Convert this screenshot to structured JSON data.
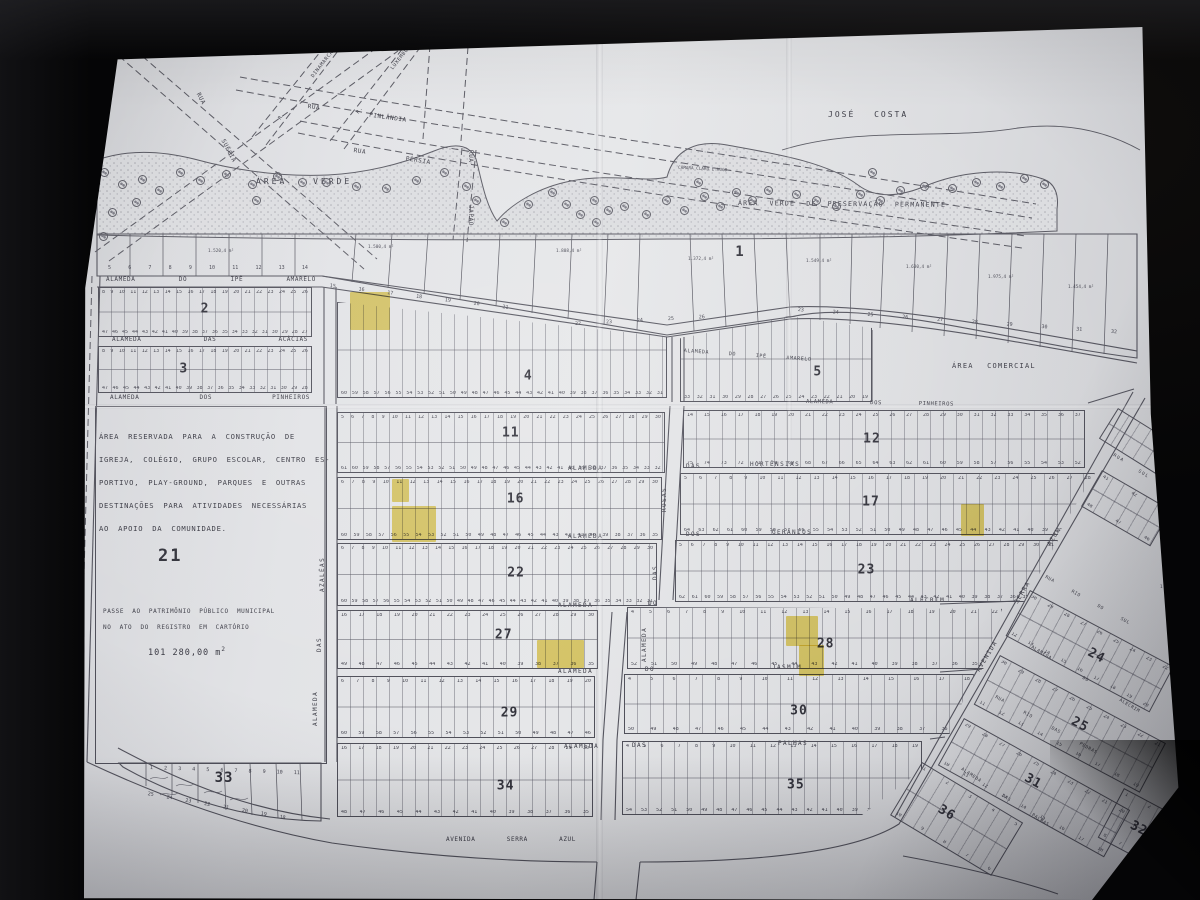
{
  "labels": {
    "owner": "JOSÉ COSTA",
    "area_verde": "ÁREA VERDE",
    "preservacao": "ÁREA VERDE DE PRESERVAÇÃO PERMANENTE",
    "comercial": "ÁREA COMERCIAL",
    "camara": "CÂMARA CLARO E HUGO"
  },
  "reserved": {
    "lines": [
      "ÁREA RESERVADA PARA A CONSTRUÇÃO DE",
      "IGREJA, COLÉGIO, GRUPO ESCOLAR, CENTRO ES-",
      "PORTIVO, PLAY-GROUND, PARQUES E OUTRAS",
      "DESTINAÇÕES PARA ATIVIDADES NECESSÁRIAS",
      "AO APOIO DA COMUNIDADE."
    ],
    "number": "21",
    "passe_lines": [
      "PASSE AO PATRIMÔNIO PÚBLICO MUNICIPAL",
      "NO ATO DO REGISTRO EM CARTÓRIO"
    ],
    "area_value": "101 280,00 m",
    "area_sup": "2"
  },
  "street_labels": [
    {
      "id": "alameda-do-ipe-amarelo-w",
      "t": "ALAMEDA DO IPÊ AMARELO",
      "x": 106,
      "y": 277,
      "r": 0,
      "w": 210
    },
    {
      "id": "alameda-do-ipe-amarelo-e",
      "t": "ALAMEDA DO IPÊ AMARELO",
      "x": 684,
      "y": 349,
      "r": 4,
      "w": 128,
      "fs": 5
    },
    {
      "id": "alameda-das-acacias",
      "t": "ALAMEDA DAS ACÁCIAS",
      "x": 112,
      "y": 337,
      "r": 0,
      "w": 196
    },
    {
      "id": "alameda-dos-pinheiros-w",
      "t": "ALAMEDA DOS PINHEIROS",
      "x": 110,
      "y": 395,
      "r": 0,
      "w": 200
    },
    {
      "id": "alameda-dos-pinheiros-e",
      "t": "ALAMEDA DOS PINHEIROS",
      "x": 806,
      "y": 400,
      "r": 1,
      "w": 148,
      "fs": 5.5
    },
    {
      "id": "alameda-das-hortensias-1",
      "t": "ALAMEDA",
      "x": 568,
      "y": 466,
      "r": 0
    },
    {
      "id": "alameda-das-hortensias-2",
      "t": "DAS",
      "x": 686,
      "y": 464,
      "r": 0
    },
    {
      "id": "alameda-das-hortensias-3",
      "t": "HORTÊNSIAS",
      "x": 750,
      "y": 462,
      "r": 0
    },
    {
      "id": "alameda-dos-geranios-1",
      "t": "ALAMEDA",
      "x": 568,
      "y": 534,
      "r": 0
    },
    {
      "id": "alameda-dos-geranios-2",
      "t": "DOS",
      "x": 686,
      "y": 532,
      "r": 0
    },
    {
      "id": "alameda-dos-geranios-3",
      "t": "GERÂNIOS",
      "x": 772,
      "y": 530,
      "r": 0
    },
    {
      "id": "alameda-do-alecrim-1",
      "t": "ALAMEDA",
      "x": 558,
      "y": 603,
      "r": 0
    },
    {
      "id": "alameda-do-alecrim-2",
      "t": "DO",
      "x": 648,
      "y": 601,
      "r": 0
    },
    {
      "id": "alameda-do-alecrim-3",
      "t": "ALECRIM",
      "x": 910,
      "y": 598,
      "r": 0
    },
    {
      "id": "alameda-do-jasmim-1",
      "t": "ALAMEDA",
      "x": 558,
      "y": 669,
      "r": 0
    },
    {
      "id": "alameda-do-jasmim-2",
      "t": "DO",
      "x": 645,
      "y": 667,
      "r": 0
    },
    {
      "id": "alameda-do-jasmim-3",
      "t": "JASMIM",
      "x": 772,
      "y": 665,
      "r": 0
    },
    {
      "id": "alameda-das-palmas-1",
      "t": "ALAMEDA",
      "x": 564,
      "y": 744,
      "r": 0
    },
    {
      "id": "alameda-das-palmas-2",
      "t": "DAS",
      "x": 632,
      "y": 743,
      "r": 0
    },
    {
      "id": "alameda-das-palmas-3",
      "t": "PALMAS",
      "x": 778,
      "y": 741,
      "r": 0
    },
    {
      "id": "alameda-das-rosas-1",
      "t": "ROSAS",
      "x": 662,
      "y": 512,
      "r": -90
    },
    {
      "id": "alameda-das-rosas-2",
      "t": "DAS",
      "x": 653,
      "y": 580,
      "r": -90
    },
    {
      "id": "alameda-das-rosas-3",
      "t": "ALAMEDA",
      "x": 642,
      "y": 662,
      "r": -90
    },
    {
      "id": "alameda-das-azaleas-1",
      "t": "AZALÉAS",
      "x": 320,
      "y": 592,
      "r": -90
    },
    {
      "id": "alameda-das-azaleas-2",
      "t": "DAS",
      "x": 317,
      "y": 652,
      "r": -90
    },
    {
      "id": "alameda-das-azaleas-3",
      "t": "ALAMEDA",
      "x": 313,
      "y": 726,
      "r": -90
    },
    {
      "id": "avenida-serra-azul",
      "t": "AVENIDA SERRA AZUL",
      "x": 446,
      "y": 837,
      "r": 0,
      "w": 130
    },
    {
      "id": "avenida-serra-azul-d1",
      "t": "AVENIDA",
      "x": 976,
      "y": 670,
      "r": -59
    },
    {
      "id": "avenida-serra-azul-d2",
      "t": "SERRA",
      "x": 1014,
      "y": 602,
      "r": -59
    },
    {
      "id": "avenida-serra-azul-d3",
      "t": "AZUL",
      "x": 1047,
      "y": 544,
      "r": -59
    },
    {
      "id": "rua-finlandia",
      "t": "RUA FINLÂNDIA",
      "x": 308,
      "y": 104,
      "r": 8,
      "w": 100
    },
    {
      "id": "rua-persia",
      "t": "RUA PÉRSIA",
      "x": 354,
      "y": 148,
      "r": 9,
      "w": 78
    },
    {
      "id": "rua-japao",
      "t": "RUA JAPÃO",
      "x": 473,
      "y": 150,
      "r": 90,
      "w": 76
    },
    {
      "id": "rua-suecia",
      "t": "RUA SUÉCIA",
      "x": 200,
      "y": 92,
      "r": 62,
      "w": 78
    },
    {
      "id": "rua-dinamarca",
      "t": "R. DINAMARCA",
      "x": 278,
      "y": 118,
      "r": -52,
      "w": 86,
      "fs": 5
    },
    {
      "id": "rua-luxemburgo",
      "t": "R. LUXEMBURGO",
      "x": 356,
      "y": 112,
      "r": -52,
      "w": 92,
      "fs": 5
    },
    {
      "id": "rua-rio-do-sul",
      "t": "RUA RIO DO SUL",
      "x": 1046,
      "y": 576,
      "r": 29,
      "w": 96,
      "fs": 4.5
    },
    {
      "id": "alameda-do-alecrim-d",
      "t": "ALAMEDA DO ALECRIM",
      "x": 1032,
      "y": 646,
      "r": 31,
      "w": 126,
      "fs": 4.5
    },
    {
      "id": "rua-rio-das-pedras",
      "t": "RUA RIO DAS PEDRAS",
      "x": 996,
      "y": 696,
      "r": 29,
      "w": 116,
      "fs": 4.5
    },
    {
      "id": "alameda-das-palmas-d",
      "t": "ALAMEDA DAS PALMAS",
      "x": 962,
      "y": 768,
      "r": 33,
      "w": 104,
      "fs": 4.5
    },
    {
      "id": "rua-ne",
      "t": "RUA",
      "x": 1114,
      "y": 454,
      "r": 32,
      "fs": 4.5
    },
    {
      "id": "rua-ne-sul",
      "t": "SUL",
      "x": 1139,
      "y": 470,
      "r": 32,
      "fs": 4.5
    }
  ],
  "blocks": [
    {
      "n": "2",
      "x": 98,
      "y": 287,
      "w": 214,
      "h": 50,
      "nx": 50,
      "ny": 44,
      "top": "8 9 10 11 12 13 14 15 16 17 18 19 20 21 22 23 24 25 26",
      "bot": "47 46 45 44 43 42 41 40 39 38 37 36 35 34 33 32 31 30 29 28 27"
    },
    {
      "n": "3",
      "x": 98,
      "y": 346,
      "w": 214,
      "h": 47,
      "nx": 40,
      "ny": 48,
      "top": "8 9 10 11 12 13 14 15 16 17 18 19 20 21 22 23 24 25 26",
      "bot": "47 46 45 44 43 42 41 40 39 38 37 36 35 34 33 32 31 30 29 28"
    },
    {
      "n": "4",
      "x": 337,
      "y": 302,
      "w": 330,
      "h": 96,
      "nx": 58,
      "ny": 78,
      "clip": "polygon(0% 0%,100% 36%,100% 100%,0% 100%)",
      "top": "",
      "bot": "60 59 58 57 56 55 54 53 52 51 50 49 48 47 46 45 44 43 42 41 40 39 38 37 36 35 34 33 32 31"
    },
    {
      "n": "5",
      "x": 680,
      "y": 316,
      "w": 192,
      "h": 86,
      "nx": 72,
      "ny": 66,
      "clip": "polygon(0% 26%,57% 0%,100% 14%,100% 100%,0% 100%)",
      "top": "",
      "bot": "33 32 31 30 29 28 27 26 25 24 23 22 21 20 19"
    },
    {
      "n": "11",
      "x": 337,
      "y": 412,
      "w": 328,
      "h": 61,
      "nx": 53,
      "ny": 34,
      "top": "5 6 7 8 9 10 11 12 13 14 15 16 17 18 19 20 21 22 23 24 25 26 27 28 29 30",
      "bot": "61 60 59 58 57 56 55 54 53 52 51 50 49 48 47 46 45 44 43 42 41 40 39 38 37 36 35 34 33 32"
    },
    {
      "n": "12",
      "x": 683,
      "y": 410,
      "w": 402,
      "h": 58,
      "nx": 47,
      "ny": 50,
      "top": "14 15 16 17 18 19 20 21 22 23 24 25 26 27 28 29 30 31 32 33 34 35 36 37",
      "bot": "75 74 73 72 71 70 69 68 67 66 65 64 63 62 61 60 59 58 57 56 55 54 53 52"
    },
    {
      "n": "16",
      "x": 337,
      "y": 477,
      "w": 325,
      "h": 63,
      "nx": 55,
      "ny": 34,
      "top": "6 7 8 9 10 11 12 13 14 15 16 17 18 19 20 21 22 23 24 25 26 27 28 29 30",
      "bot": "60 59 58 57 56 55 54 53 52 51 50 49 48 47 46 45 44 43 42 41 40 39 38 37 36 35"
    },
    {
      "n": "17",
      "x": 680,
      "y": 473,
      "w": 415,
      "h": 62,
      "nx": 46,
      "ny": 46,
      "clip": "polygon(0% 0%,100% 0%,91% 100%,0% 100%)",
      "top": "5 6 7 8 9 10 11 12 13 14 15 16 17 18 19 20 21 22 23 24 25 26 27 28",
      "bot": "64 63 62 61 60 59 58 57 56 55 54 53 52 51 50 49 48 47 46 45 44 43 42 41 40 39 38 37 36"
    },
    {
      "n": "22",
      "x": 337,
      "y": 543,
      "w": 320,
      "h": 63,
      "nx": 56,
      "ny": 48,
      "top": "6 7 8 9 10 11 12 13 14 15 16 17 18 19 20 21 22 23 24 25 26 27 28 29 30",
      "bot": "60 59 58 57 56 55 54 53 52 51 50 49 48 47 46 45 44 43 42 41 40 39 38 37 36 35 34 33 32 31"
    },
    {
      "n": "23",
      "x": 675,
      "y": 540,
      "w": 383,
      "h": 62,
      "nx": 50,
      "ny": 48,
      "clip": "polygon(0% 0%,100% 0%,91% 100%,0% 100%)",
      "top": "5 6 7 8 9 10 11 12 13 14 15 16 17 18 19 20 21 22 23 24 25 26 27 28 29 30 31",
      "bot": "62 61 60 59 58 57 56 55 54 53 52 51 50 49 48 47 46 45 44 43 42 41 40 39 38 37 36 35 34 33"
    },
    {
      "n": "27",
      "x": 337,
      "y": 610,
      "w": 261,
      "h": 59,
      "nx": 64,
      "ny": 42,
      "top": "16 17 18 19 20 21 22 23 24 25 26 27 28 29 30",
      "bot": "49 48 47 46 45 44 43 42 41 40 39 38 37 36 35"
    },
    {
      "n": "28",
      "x": 627,
      "y": 607,
      "w": 375,
      "h": 62,
      "nx": 53,
      "ny": 60,
      "clip": "polygon(0% 0%,100% 3%,95% 100%,0% 100%)",
      "top": "4 5 6 7 8 9 10 11 12 13 14 15 16 17 18 19 20 21 22",
      "bot": "52 51 50 49 48 47 46 45 44 43 42 41 40 39 38 37 36 35 34"
    },
    {
      "n": "29",
      "x": 337,
      "y": 676,
      "w": 258,
      "h": 62,
      "nx": 67,
      "ny": 60,
      "top": "6 7 8 9 10 11 12 13 14 15 16 17 18 19 20",
      "bot": "60 59 58 57 56 55 54 53 52 51 50 49 48 47 46"
    },
    {
      "n": "30",
      "x": 624,
      "y": 674,
      "w": 350,
      "h": 60,
      "nx": 50,
      "ny": 62,
      "clip": "polygon(0% 0%,100% 0%,93% 100%,0% 100%)",
      "top": "4 5 6 7 8 9 10 11 12 13 14 15 16 17 18",
      "bot": "50 49 48 47 46 45 44 43 42 41 40 39 38 37 36 35"
    },
    {
      "n": "34",
      "x": 337,
      "y": 743,
      "w": 256,
      "h": 74,
      "nx": 66,
      "ny": 58,
      "top": "16 17 18 19 20 21 22 23 24 25 26 27 28 29 30",
      "bot": "48 47 46 45 44 43 42 41 40 39 38 37 36 35"
    },
    {
      "n": "35",
      "x": 622,
      "y": 741,
      "w": 300,
      "h": 74,
      "nx": 58,
      "ny": 60,
      "clip": "polygon(0% 0%,100% 0%,100% 38%,80% 100%,0% 100%)",
      "top": "4 5 6 7 8 9 10 11 12 13 14 15 16 17 18 19",
      "bot": "54 53 52 51 50 49 48 47 46 45 44 43 42 41 40 39 38 37 36 35"
    },
    {
      "n": "24",
      "x": 1030,
      "y": 590,
      "w": 163,
      "h": 52,
      "r": 28,
      "nx": 55,
      "ny": 52,
      "top": "30 29 28 27 26 25 24 23 22",
      "bot": "12 13 14 15 16 17 18 19 20"
    },
    {
      "n": "25",
      "x": 1000,
      "y": 655,
      "w": 188,
      "h": 56,
      "r": 28,
      "nx": 55,
      "ny": 42,
      "top": "30 29 28 27 26 25 24 23 22 21",
      "bot": "11 12 13 14 15 16 17 18 19"
    },
    {
      "n": "31",
      "x": 964,
      "y": 718,
      "w": 190,
      "h": 54,
      "r": 29,
      "nx": 48,
      "ny": 40,
      "top": "29 28 27 26 25 24 23 22 21 20",
      "bot": "10 11 12 13 14 15 16 17 18"
    },
    {
      "n": "36",
      "x": 922,
      "y": 762,
      "w": 118,
      "h": 62,
      "r": 31,
      "nx": 40,
      "ny": 50,
      "top": "1 2 3 4 5",
      "bot": "10 9 8 7 6"
    },
    {
      "n": "32",
      "x": 1124,
      "y": 788,
      "w": 62,
      "h": 56,
      "r": 28,
      "nx": 52,
      "ny": 52,
      "top": "1 2 3",
      "bot": "8 7 6 5"
    },
    {
      "n": "",
      "x": 1102,
      "y": 470,
      "w": 80,
      "h": 42,
      "r": 30,
      "top": "41 42 43",
      "bot": "48 47 46"
    },
    {
      "n": "",
      "x": 1118,
      "y": 408,
      "w": 70,
      "h": 36,
      "r": 32,
      "top": "",
      "bot": ""
    }
  ],
  "highlights": [
    {
      "x": 350,
      "y": 292,
      "w": 40,
      "h": 38
    },
    {
      "x": 392,
      "y": 479,
      "w": 17,
      "h": 23
    },
    {
      "x": 392,
      "y": 506,
      "w": 44,
      "h": 36
    },
    {
      "x": 961,
      "y": 504,
      "w": 23,
      "h": 32
    },
    {
      "x": 537,
      "y": 640,
      "w": 47,
      "h": 28
    },
    {
      "x": 786,
      "y": 616,
      "w": 32,
      "h": 30
    },
    {
      "x": 799,
      "y": 645,
      "w": 25,
      "h": 31
    }
  ],
  "misc": {
    "block1": {
      "number": "1",
      "x": 740,
      "y": 252
    },
    "block33": {
      "number": "33",
      "x": 224,
      "y": 778
    },
    "area_labels": [
      [
        "1.520,4 m²",
        208,
        250
      ],
      [
        "1.500,4 m²",
        368,
        246
      ],
      [
        "1.808,4 m²",
        556,
        250
      ],
      [
        "1.372,4 m²",
        688,
        258
      ],
      [
        "1.549,4 m²",
        806,
        260
      ],
      [
        "1.630,4 m²",
        906,
        266
      ],
      [
        "1.975,4 m²",
        988,
        276
      ],
      [
        "1.454,4 m²",
        1068,
        286
      ],
      [
        "1",
        1160,
        586
      ]
    ],
    "number_strips": [
      [
        "5 6 7 8 9 10 11 12 13 14",
        108,
        266,
        0,
        200
      ],
      [
        "15 16 17 18 19 20 21",
        330,
        284,
        7,
        180
      ],
      [
        "22 23 24 25 26",
        575,
        322,
        -3,
        130
      ],
      [
        "23 24 25 26 27 28 29 30 31 32",
        798,
        308,
        4,
        320
      ],
      [
        "1 2 3 4 5 6 7 8 9 10 11",
        150,
        766,
        2,
        150
      ],
      [
        "25 24 23 22 21 20 19 18",
        148,
        792,
        10,
        140
      ]
    ]
  },
  "trees": [
    [
      100,
      168
    ],
    [
      118,
      180
    ],
    [
      138,
      175
    ],
    [
      155,
      186
    ],
    [
      132,
      198
    ],
    [
      108,
      208
    ],
    [
      99,
      232
    ],
    [
      176,
      168
    ],
    [
      196,
      176
    ],
    [
      222,
      170
    ],
    [
      248,
      180
    ],
    [
      273,
      172
    ],
    [
      298,
      178
    ],
    [
      252,
      196
    ],
    [
      322,
      178
    ],
    [
      352,
      182
    ],
    [
      382,
      184
    ],
    [
      412,
      176
    ],
    [
      440,
      168
    ],
    [
      462,
      182
    ],
    [
      472,
      196
    ],
    [
      500,
      218
    ],
    [
      524,
      200
    ],
    [
      548,
      188
    ],
    [
      562,
      200
    ],
    [
      576,
      210
    ],
    [
      590,
      196
    ],
    [
      604,
      206
    ],
    [
      592,
      218
    ],
    [
      620,
      202
    ],
    [
      642,
      210
    ],
    [
      662,
      196
    ],
    [
      680,
      206
    ],
    [
      700,
      192
    ],
    [
      716,
      202
    ],
    [
      732,
      188
    ],
    [
      748,
      196
    ],
    [
      764,
      186
    ],
    [
      792,
      190
    ],
    [
      812,
      196
    ],
    [
      832,
      202
    ],
    [
      856,
      190
    ],
    [
      876,
      196
    ],
    [
      896,
      186
    ],
    [
      920,
      182
    ],
    [
      948,
      184
    ],
    [
      972,
      178
    ],
    [
      996,
      182
    ],
    [
      1020,
      174
    ],
    [
      1040,
      180
    ],
    [
      868,
      168
    ],
    [
      694,
      178
    ]
  ]
}
